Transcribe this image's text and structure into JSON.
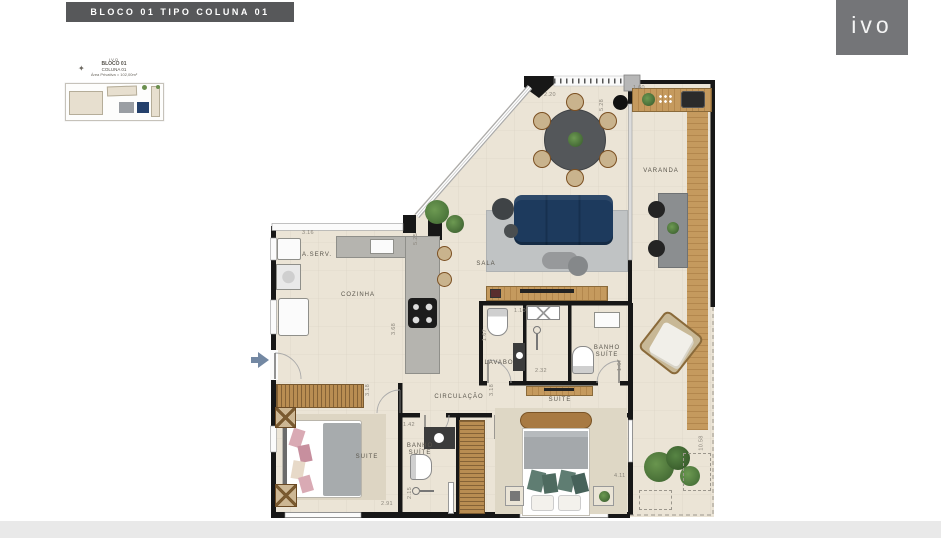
{
  "header": {
    "title": "BLOCO 01 TIPO COLUNA 01"
  },
  "brand": {
    "logo_text": "ivo"
  },
  "thumbnail": {
    "line1": "IVO",
    "block": "BLOCO 01",
    "column": "COLUNA 01",
    "area": "Área Privativa = 102,00m²"
  },
  "plan": {
    "rooms": {
      "varanda": "VARANDA",
      "sala": "SALA",
      "cozinha": "COZINHA",
      "area_servico": "A.SERV.",
      "lavabo": "LAVABO",
      "banho_suite_right": "BANHO SUÍTE",
      "suite_master": "SUÍTE",
      "circulacao": "CIRCULAÇÃO",
      "suite_left": "SUITE",
      "banho_suite_left": "BANHO SUÍTE"
    },
    "dimensions": [
      "2.20",
      "5.28",
      "1.60",
      "3.16",
      "5.25",
      "3.68",
      "1.10",
      "1.67",
      "2.32",
      "1.67",
      "3.18",
      "3.18",
      "1.42",
      "2.15",
      "2.91",
      "4.11",
      "10.58"
    ]
  },
  "colors": {
    "title_bar": "#57585a",
    "logo_box": "#747578",
    "wall": "#171717",
    "floor": "#ebe4d6",
    "wood": "#b98d52",
    "sofa_navy": "#1d3a5d",
    "counter_gray": "#b5b4af",
    "plant_green": "#4c7a3c",
    "entry_arrow": "#7388a3"
  }
}
